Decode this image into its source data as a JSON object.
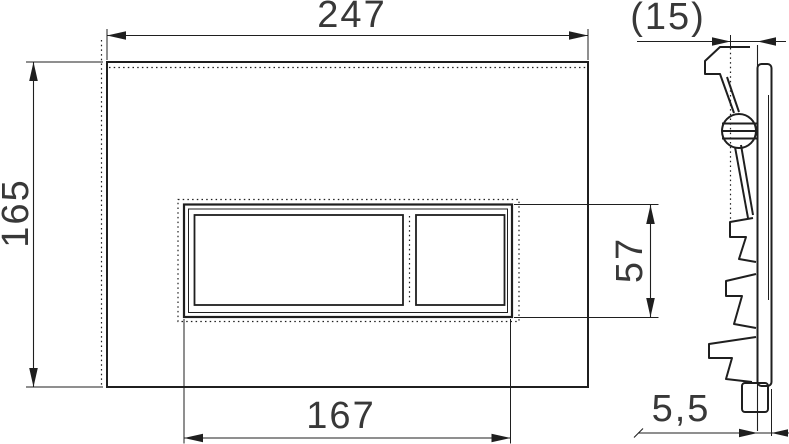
{
  "drawing_type": "technical dimension drawing",
  "subject": "wall flush plate with two rectangular buttons, front view and side profile",
  "colors": {
    "background": "#ffffff",
    "line": "#1f1f1f",
    "text": "#383838"
  },
  "front_view": {
    "labels": {
      "overall_width": "247",
      "overall_height": "165",
      "button_panel_width": "167",
      "button_panel_height": "57"
    }
  },
  "side_view": {
    "labels": {
      "overall_depth": "(15)",
      "panel_thickness": "5,5"
    }
  }
}
